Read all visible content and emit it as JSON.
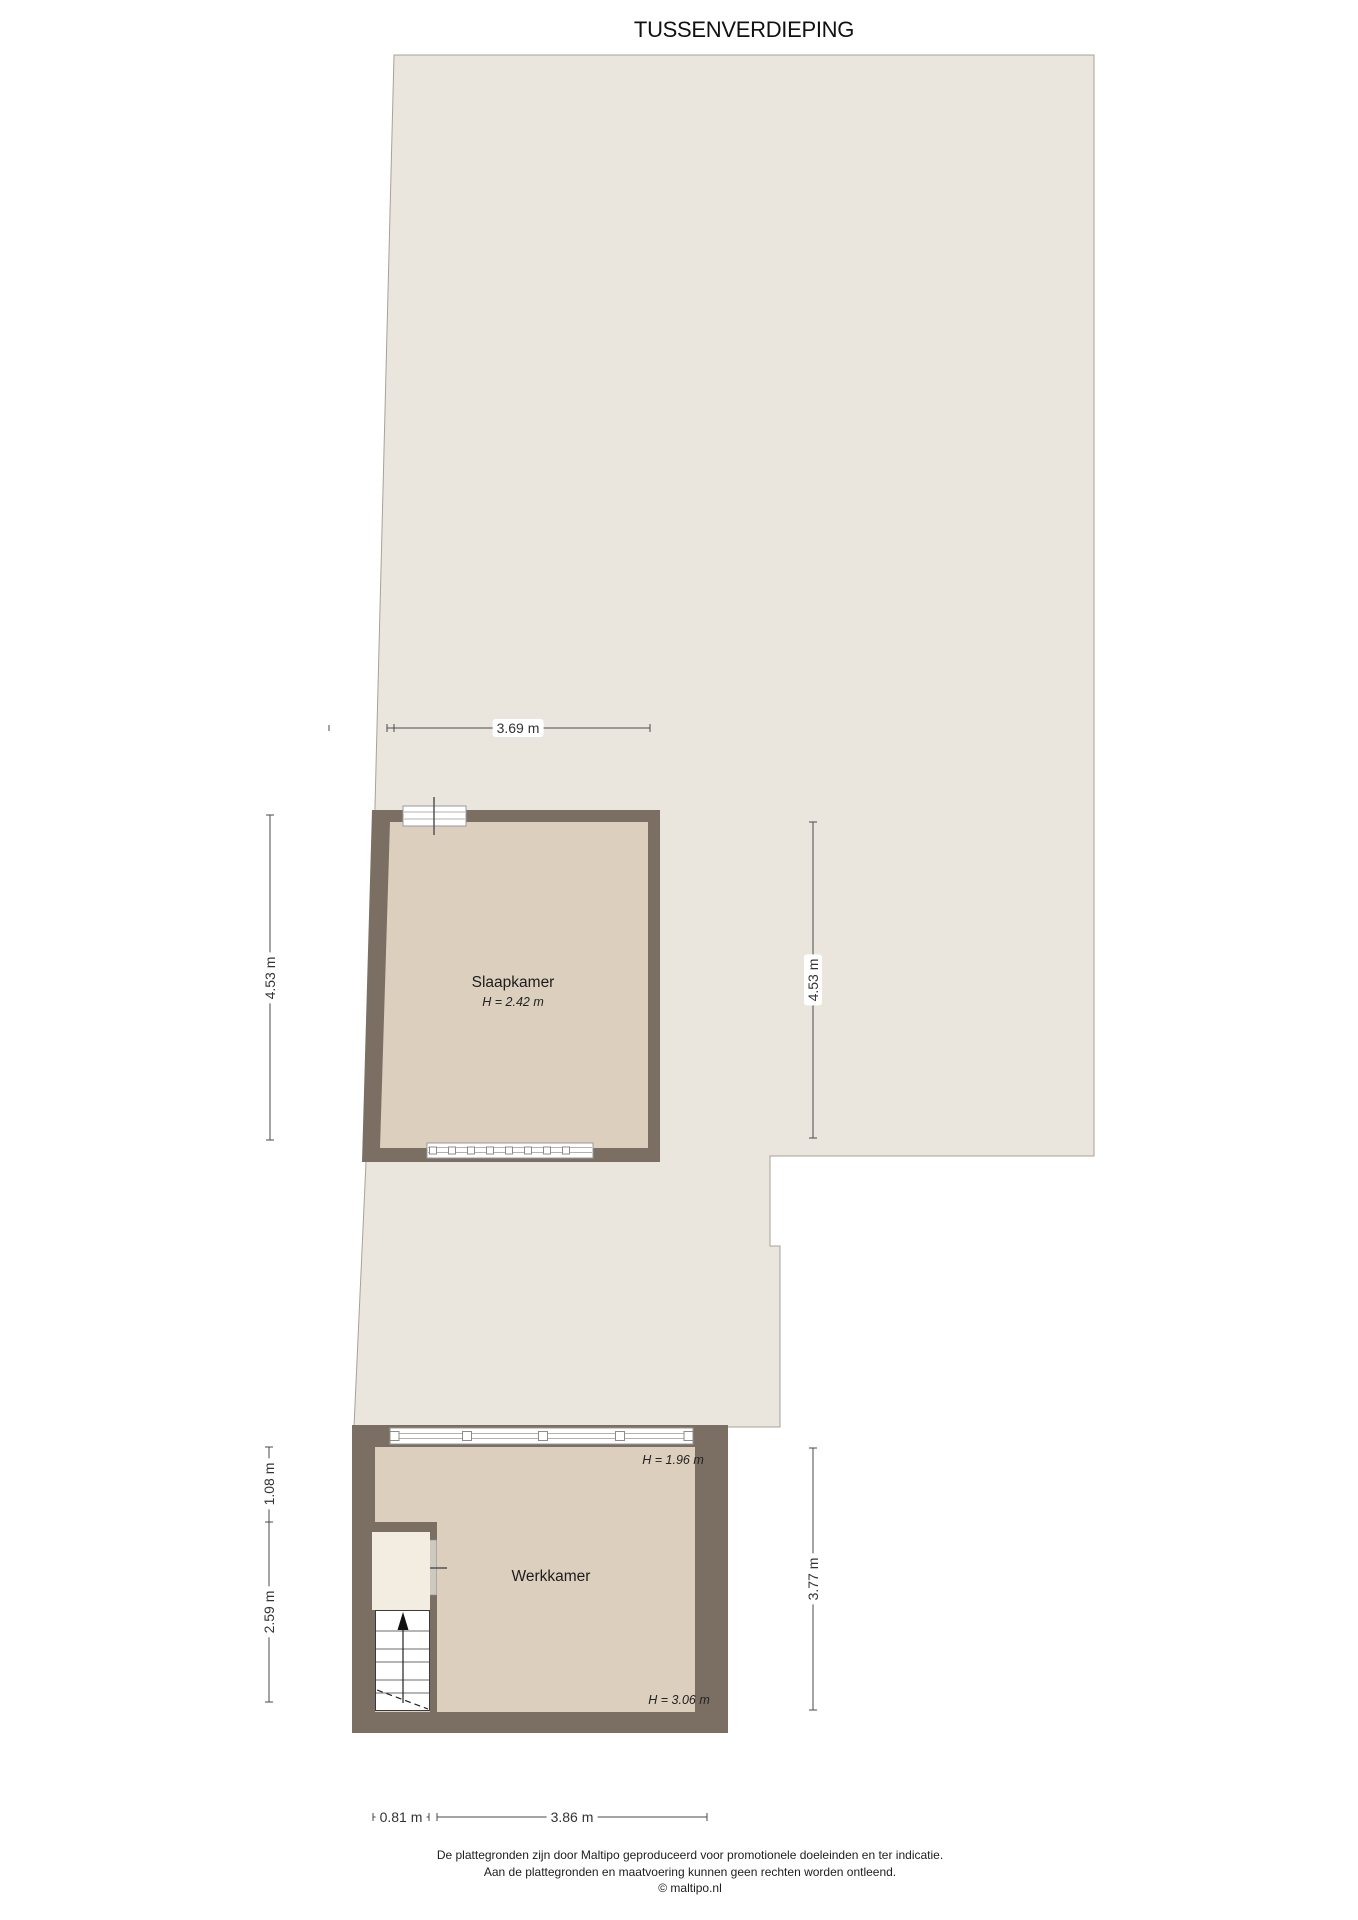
{
  "title": "TUSSENVERDIEPING",
  "colors": {
    "background": "#ffffff",
    "floor_open": "#eae6dd",
    "floor_room": "#ddcfbd",
    "floor_landing": "#f2ece1",
    "wall": "#7b6f63",
    "outline": "#a8a296",
    "dimension": "#4a4a4a",
    "text": "#222222",
    "window_frame": "#9a9a9a",
    "door": "#cdc9c1"
  },
  "rooms": {
    "slaapkamer": {
      "name": "Slaapkamer",
      "height": "H = 2.42 m"
    },
    "werkkamer": {
      "name": "Werkkamer",
      "height_top": "H = 1.96 m",
      "height_bottom": "H = 3.06 m"
    }
  },
  "dimensions": {
    "top_width": "3.69 m",
    "left_upper": "4.53 m",
    "right_upper": "4.53 m",
    "left_mid": "1.08 m",
    "left_lower": "2.59 m",
    "right_lower": "3.77 m",
    "bottom_left": "0.81 m",
    "bottom_right": "3.86 m"
  },
  "stairs": {
    "direction": "up"
  },
  "footer": {
    "line1": "De plattegronden zijn door Maltipo geproduceerd voor promotionele doeleinden en ter indicatie.",
    "line2": "Aan de plattegronden en maatvoering kunnen geen rechten worden ontleend.",
    "line3": "© maltipo.nl"
  }
}
